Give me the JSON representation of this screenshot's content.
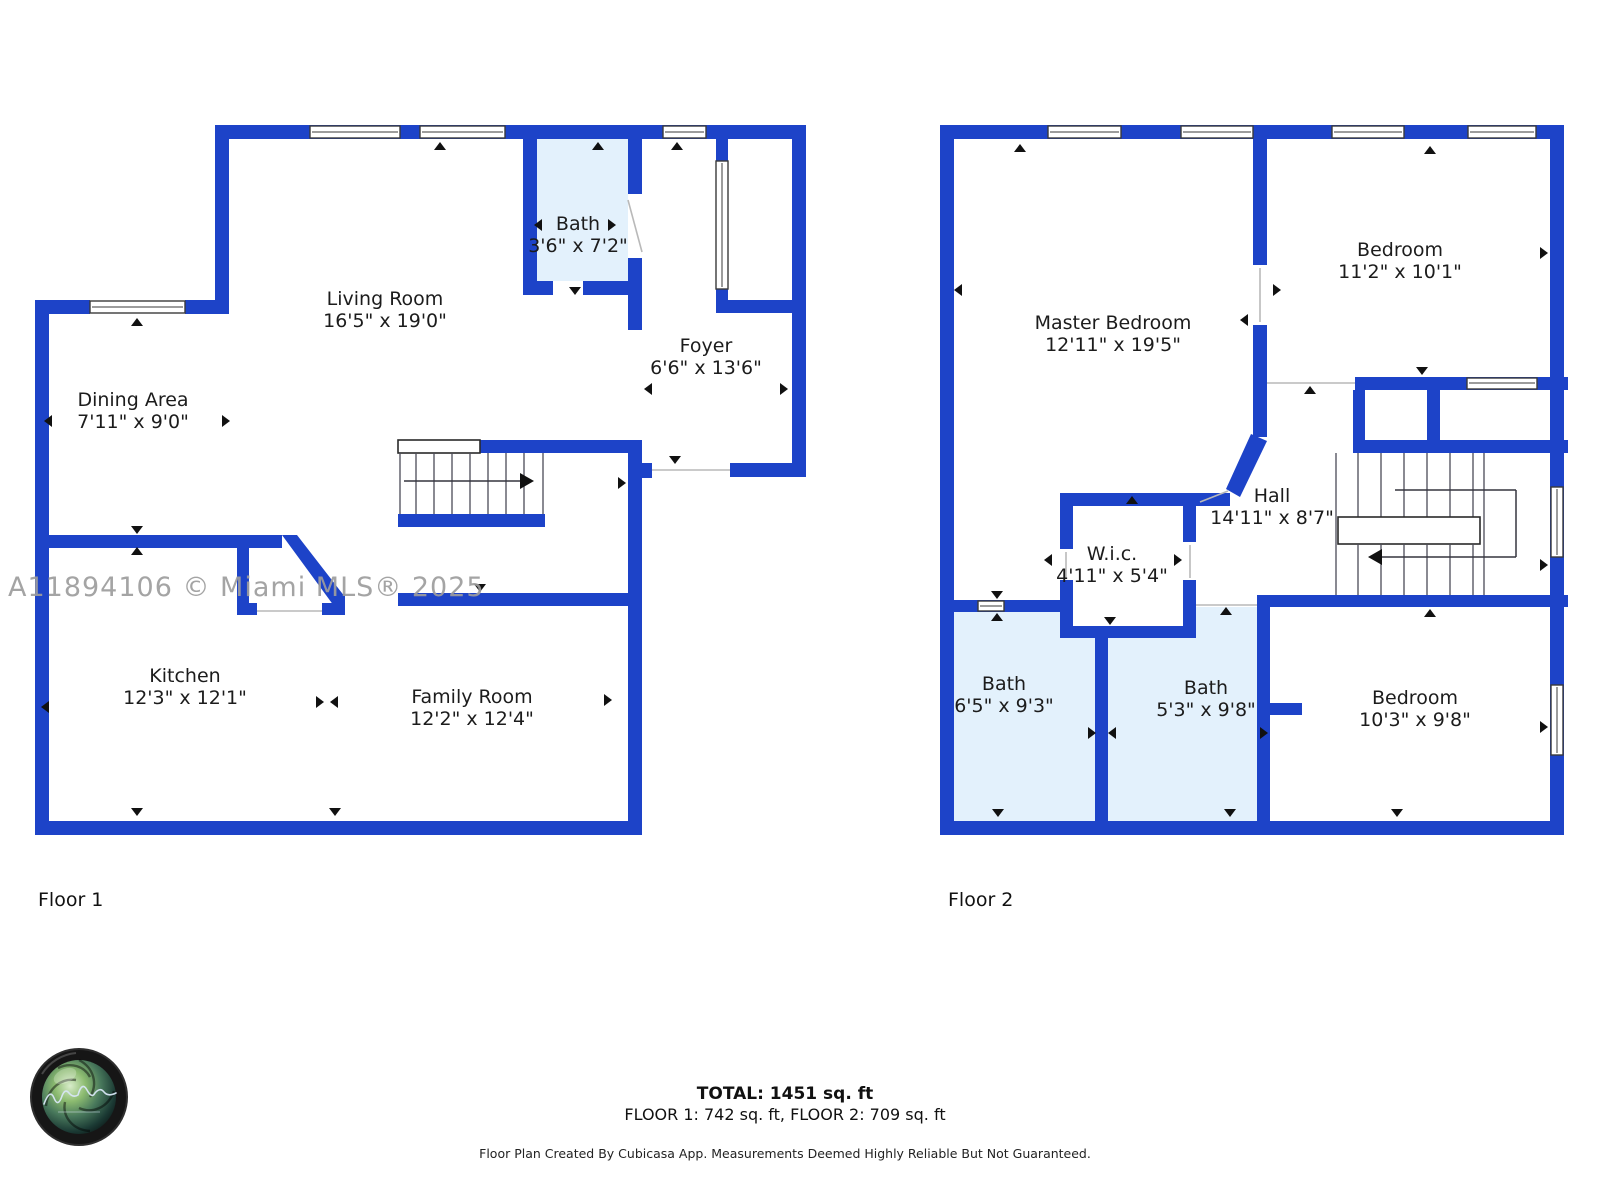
{
  "watermark": "A11894106 © Miami MLS® 2025",
  "colors": {
    "wall": "#1d43c8",
    "bath_fill": "#e3f1fc",
    "watermark_gray": "#9d9d9d"
  },
  "floor1": {
    "caption": "Floor 1",
    "rooms": [
      {
        "name": "Living Room",
        "dims": "16'5\" x 19'0\""
      },
      {
        "name": "Bath",
        "dims": "3'6\" x 7'2\""
      },
      {
        "name": "Foyer",
        "dims": "6'6\" x 13'6\""
      },
      {
        "name": "Dining Area",
        "dims": "7'11\" x 9'0\""
      },
      {
        "name": "Kitchen",
        "dims": "12'3\" x 12'1\""
      },
      {
        "name": "Family Room",
        "dims": "12'2\" x 12'4\""
      }
    ]
  },
  "floor2": {
    "caption": "Floor 2",
    "rooms": [
      {
        "name": "Master Bedroom",
        "dims": "12'11\" x 19'5\""
      },
      {
        "name": "Bedroom",
        "dims": "11'2\" x 10'1\""
      },
      {
        "name": "Hall",
        "dims": "14'11\" x 8'7\""
      },
      {
        "name": "W.i.c.",
        "dims": "4'11\" x 5'4\""
      },
      {
        "name": "Bath",
        "dims": "6'5\" x 9'3\""
      },
      {
        "name": "Bath",
        "dims": "5'3\" x 9'8\""
      },
      {
        "name": "Bedroom",
        "dims": "10'3\" x 9'8\""
      }
    ]
  },
  "footer": {
    "total": "TOTAL: 1451 sq. ft",
    "floors": "FLOOR 1: 742 sq. ft, FLOOR 2: 709 sq. ft",
    "disclaimer": "Floor Plan Created By Cubicasa App. Measurements Deemed Highly Reliable But Not Guaranteed."
  },
  "logo": {
    "icon": "camera-lens-photography-logo"
  }
}
